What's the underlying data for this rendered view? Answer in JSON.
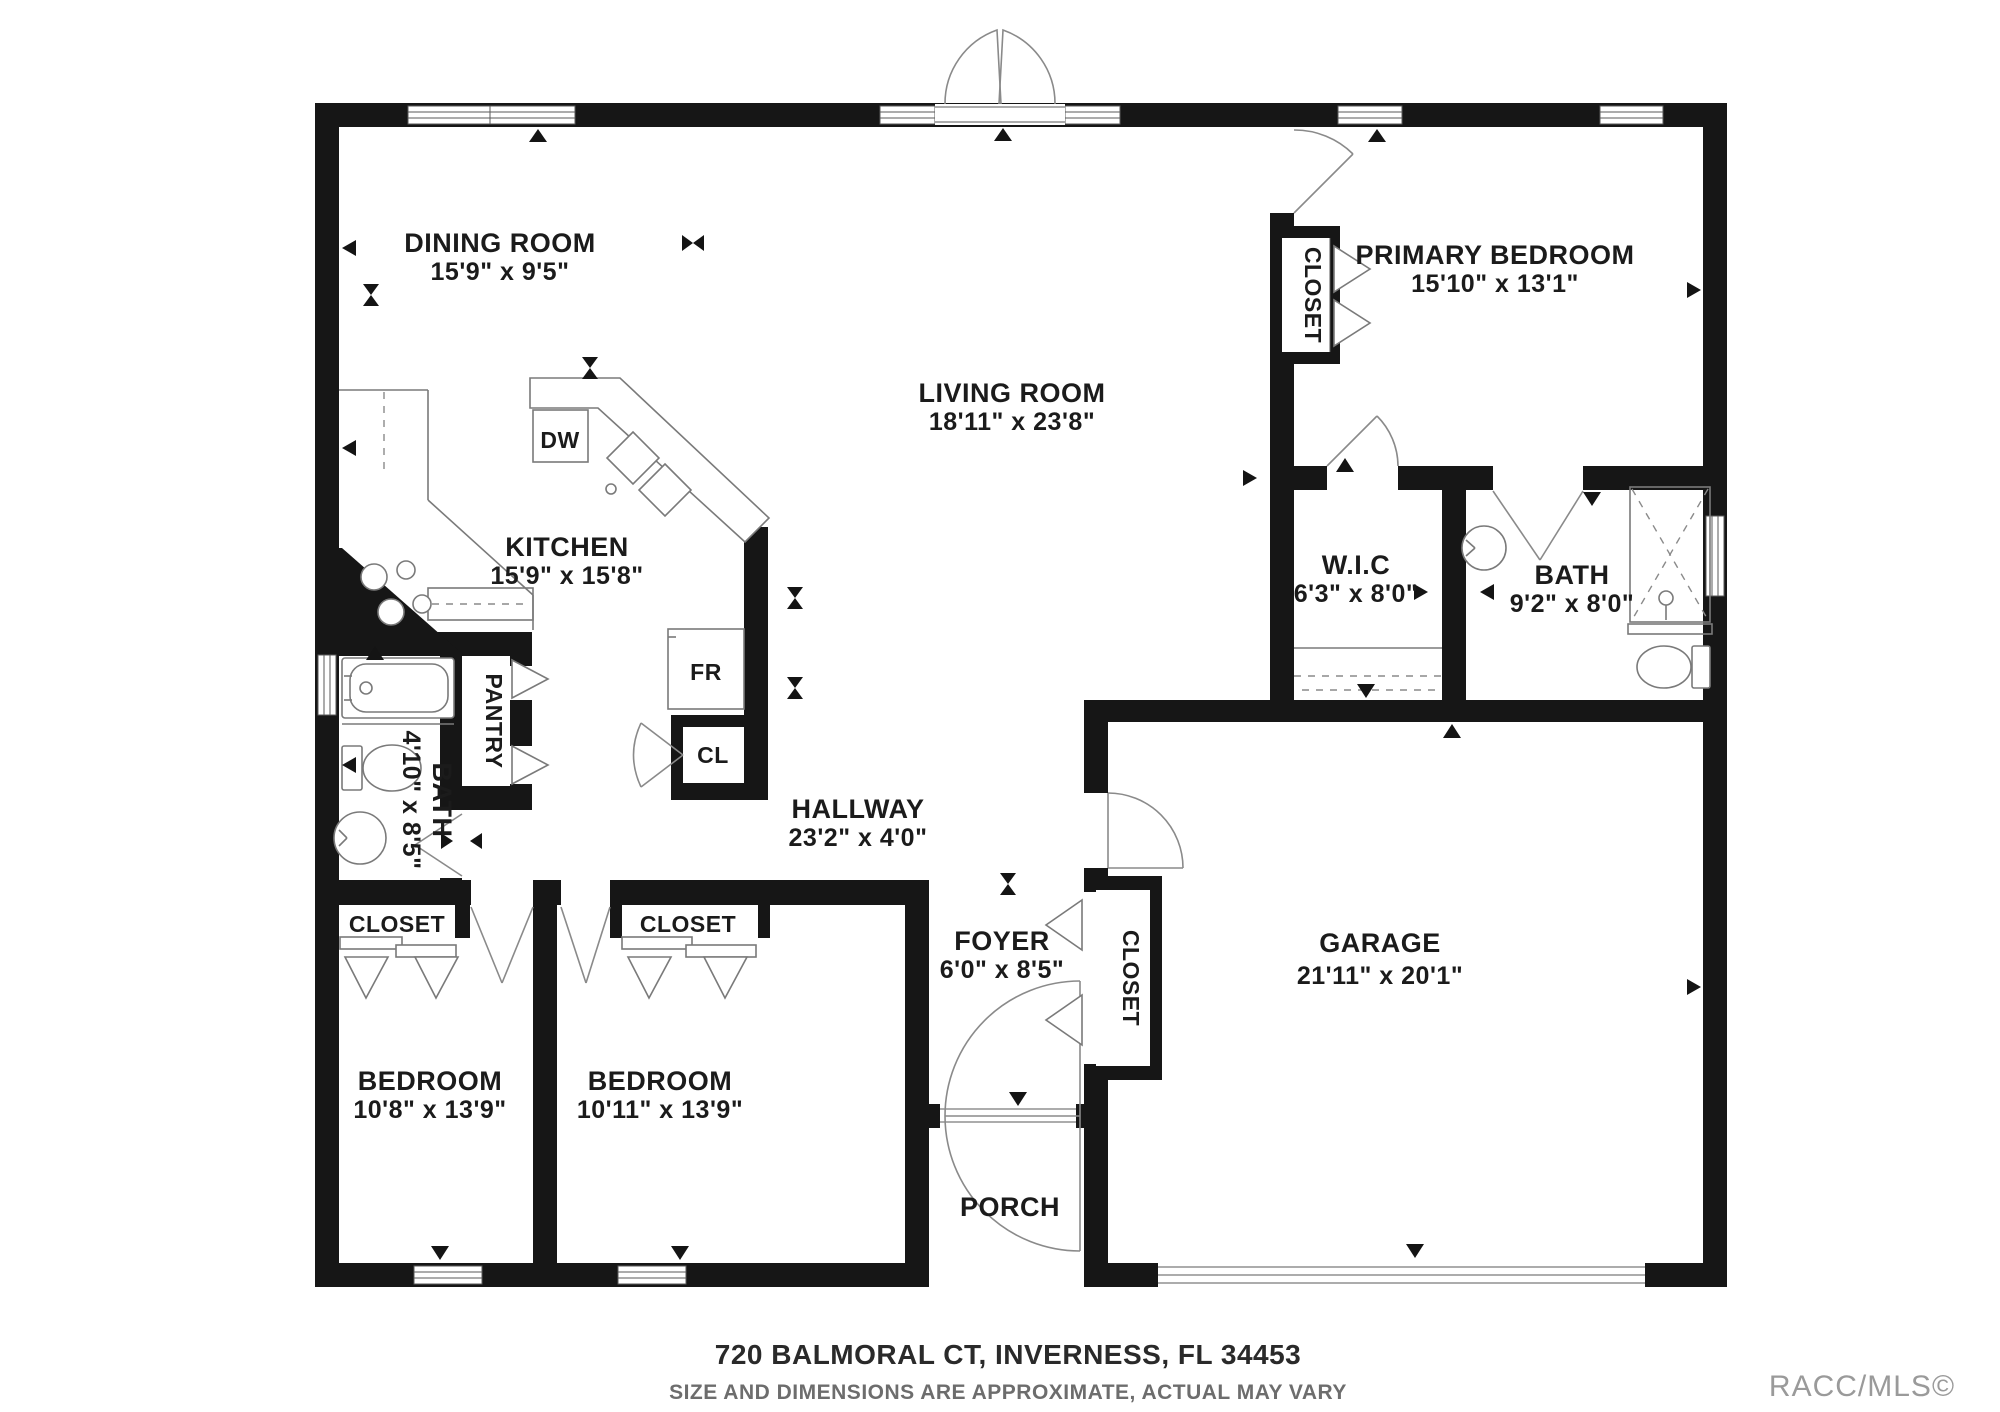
{
  "floorplan": {
    "rooms": {
      "dining": {
        "name": "DINING ROOM",
        "dims": "15'9\" x 9'5\""
      },
      "kitchen": {
        "name": "KITCHEN",
        "dims": "15'9\" x 15'8\""
      },
      "living": {
        "name": "LIVING ROOM",
        "dims": "18'11\" x 23'8\""
      },
      "primary": {
        "name": "PRIMARY BEDROOM",
        "dims": "15'10\" x 13'1\""
      },
      "wic": {
        "name": "W.I.C",
        "dims": "6'3\" x 8'0\""
      },
      "primary_bath": {
        "name": "BATH",
        "dims": "9'2\" x 8'0\""
      },
      "hall_bath": {
        "name": "BATH",
        "dims": "4'10\" x 8'5\""
      },
      "hallway": {
        "name": "HALLWAY",
        "dims": "23'2\" x 4'0\""
      },
      "foyer": {
        "name": "FOYER",
        "dims": "6'0\" x 8'5\""
      },
      "garage": {
        "name": "GARAGE",
        "dims": "21'11\" x 20'1\""
      },
      "bedroom_a": {
        "name": "BEDROOM",
        "dims": "10'8\" x 13'9\""
      },
      "bedroom_b": {
        "name": "BEDROOM",
        "dims": "10'11\" x 13'9\""
      },
      "porch": {
        "name": "PORCH"
      }
    },
    "labels": {
      "pantry": "PANTRY",
      "closet": "CLOSET",
      "cl": "CL",
      "dw": "DW",
      "fr": "FR"
    },
    "footer": {
      "address": "720 BALMORAL CT, INVERNESS, FL 34453",
      "disclaimer": "SIZE AND DIMENSIONS ARE APPROXIMATE, ACTUAL MAY VARY",
      "watermark": "RACC/MLS©"
    }
  }
}
